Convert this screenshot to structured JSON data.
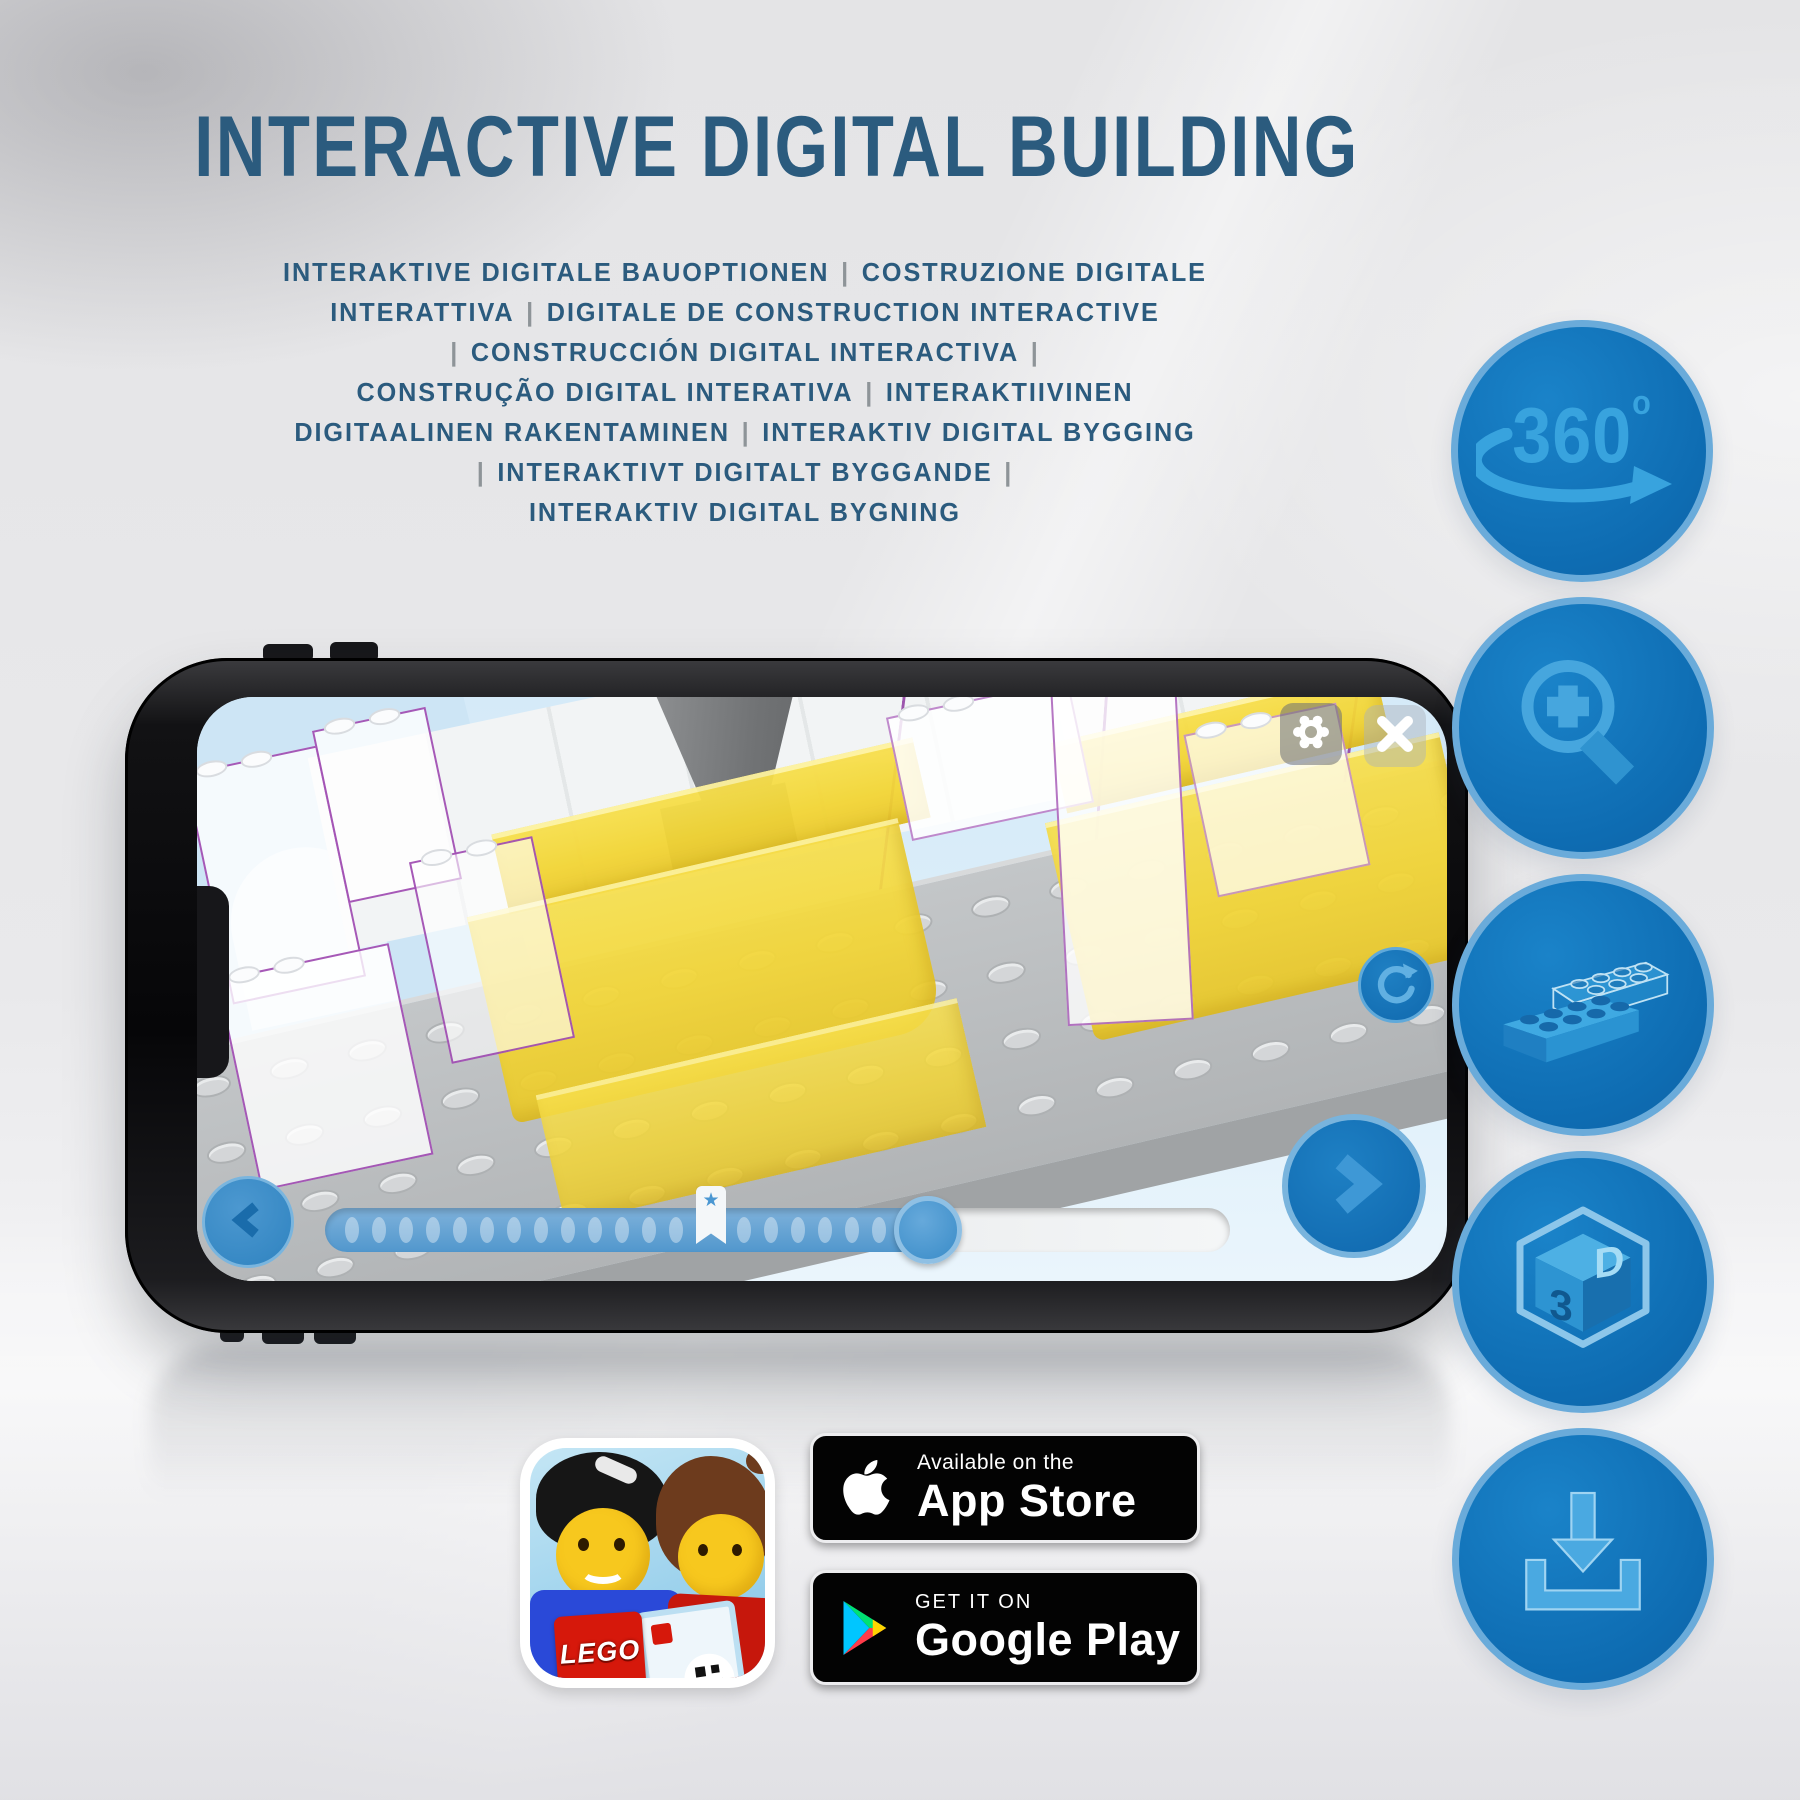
{
  "page": {
    "title": "INTERACTIVE DIGITAL BUILDING"
  },
  "subtitle": {
    "lines": [
      "INTERAKTIVE DIGITALE BAUOPTIONEN | COSTRUZIONE DIGITALE",
      "INTERATTIVA | DIGITALE DE CONSTRUCTION INTERACTIVE",
      "| CONSTRUCCIÓN DIGITAL INTERACTIVA |",
      "CONSTRUÇÃO DIGITAL INTERATIVA | INTERAKTIIVINEN",
      "DIGITAALINEN RAKENTAMINEN | INTERAKTIV DIGITAL BYGGING",
      "| INTERAKTIVT DIGITALT BYGGANDE |",
      "INTERAKTIV DIGITAL BYGNING"
    ]
  },
  "features": [
    {
      "id": "360-degrees",
      "text": "360",
      "superscript": "o"
    },
    {
      "id": "zoom-in"
    },
    {
      "id": "bricks"
    },
    {
      "id": "3d-cube",
      "face_left_text": "3",
      "face_right_text": "D"
    },
    {
      "id": "download"
    }
  ],
  "app_ui": {
    "progress": {
      "dots_before_star": 13,
      "dots_after_star": 6,
      "fill_width_px": 610,
      "star_glyph": "★"
    }
  },
  "store_badges": {
    "app_store": {
      "line1": "Available on the",
      "line2": "App Store"
    },
    "google_play": {
      "line1": "GET IT ON",
      "line2": "Google Play"
    }
  },
  "lego_icon": {
    "logo_text": "LEGO"
  },
  "colors": {
    "title_text": "#2b5b7e",
    "pipe_gray": "#8e9498",
    "circle_fill": "#1173b9",
    "circle_rim": "#6aabda",
    "glyph_blue": "#38a3de",
    "screen_bg": "#dceefa",
    "yellow_brick": "#f6dc3d",
    "plate_gray": "#bcbfc1",
    "purple_outline": "#8e34a8",
    "badge_bg": "#000000"
  }
}
